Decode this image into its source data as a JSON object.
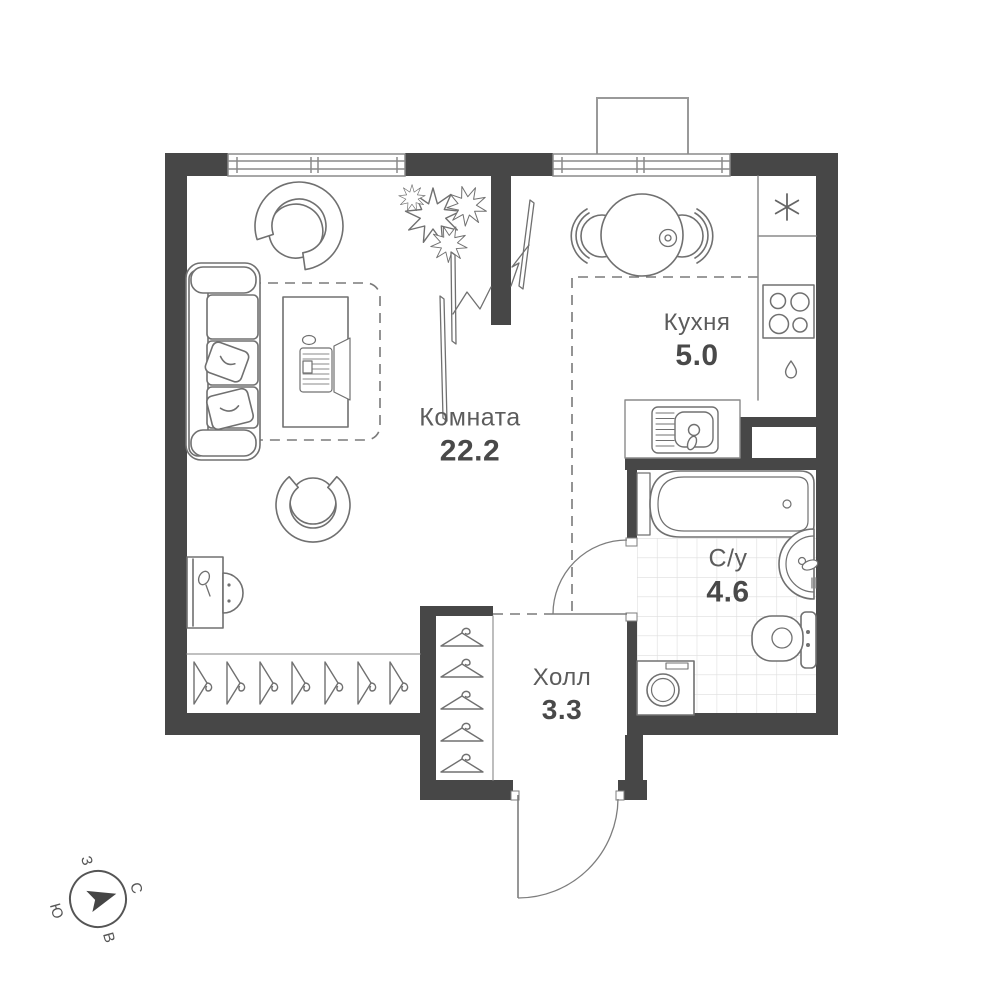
{
  "page": {
    "background": "#ffffff"
  },
  "rooms": [
    {
      "key": "room",
      "name": "Комната",
      "area": "22.2"
    },
    {
      "key": "kitchen",
      "name": "Кухня",
      "area": "5.0"
    },
    {
      "key": "bathroom",
      "name": "С/у",
      "area": "4.6"
    },
    {
      "key": "hall",
      "name": "Холл",
      "area": "3.3"
    }
  ],
  "compass": {
    "north": "С",
    "east": "В",
    "south": "Ю",
    "west": "З"
  },
  "colors": {
    "wall": "#474747",
    "furniture_line": "#707070",
    "window_line": "#8a8a8a",
    "room_name_text": "#5c5c5c",
    "area_text": "#494949",
    "tile_line": "#dedede",
    "dashed_zone": "#7a7a7a"
  },
  "icons": {
    "fridge_symbol": "six-spoke-asterisk",
    "tap_symbol": "water-droplet",
    "wardrobe_hanger_count": 7,
    "hall_closet_hanger_count": 5
  }
}
